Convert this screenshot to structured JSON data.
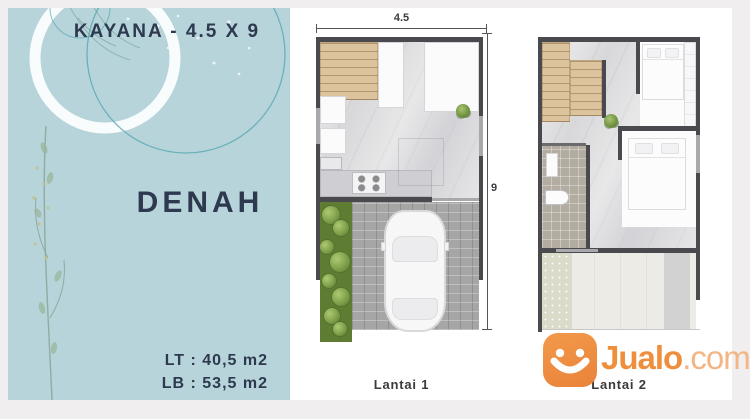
{
  "sidebar": {
    "title": "KAYANA - 4.5 X 9",
    "heading": "DENAH",
    "lt": "LT : 40,5 m2",
    "lb": "LB : 53,5 m2"
  },
  "plans": [
    {
      "label": "Lantai 1",
      "dim_width": "4.5",
      "dim_height": "9"
    },
    {
      "label": "Lantai 2"
    }
  ],
  "watermark": {
    "brand": "Jualo",
    "suffix": ".com",
    "icon": "jualo-smiley-logo"
  },
  "colors": {
    "page_bg": "#f0eeee",
    "sidebar_bg": "#b6d4da",
    "text_navy": "#2e3950",
    "wall": "#4a4a4e",
    "stair_wood": "#dcc49e",
    "grass": "#5e7d33",
    "paver": "#a6a6a6",
    "jualo_orange": "#ef8f3d",
    "jualo_suffix": "#f4b585"
  }
}
